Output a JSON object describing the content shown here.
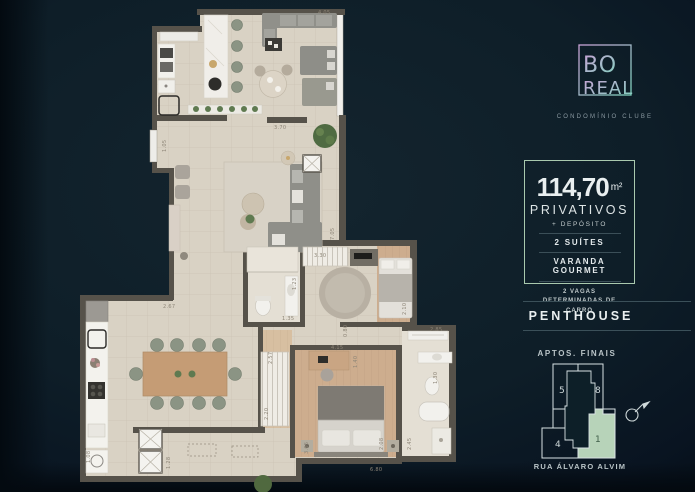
{
  "brand": {
    "line1": "BO",
    "line2": "REAL",
    "tagline": "CONDOMÍNIO CLUBE"
  },
  "specs": {
    "area_value": "114,70",
    "area_unit": "m²",
    "area_label": "PRIVATIVOS",
    "deposit": "+ DEPÓSITO",
    "features": [
      "2 SUÍTES",
      "VARANDA GOURMET"
    ],
    "parking": "2 VAGAS DETERMINADAS DE CARRO"
  },
  "unit_type": "PENTHOUSE",
  "key_plan": {
    "title": "APTOS. FINAIS",
    "street": "RUA ÁLVARO ALVIM",
    "units": [
      "5",
      "8",
      "4",
      "1"
    ],
    "highlighted_unit": "1"
  },
  "plan": {
    "dims": [
      "4.05",
      "3.70",
      "1.05",
      "7.05",
      "3.30",
      "1.23",
      "1.35",
      "2.10",
      "0.80",
      "4.15",
      "2.85",
      "2.57",
      "1.40",
      "1.30",
      "2.67",
      "2.20",
      "3.05",
      "2.08",
      "2.45",
      "6.80",
      "1.28",
      "1.08"
    ]
  },
  "colors": {
    "bg": "#0d1d27",
    "accent": "#a9c9ae",
    "key-fill": "#b7d3b9",
    "key-num": "#3f5e49",
    "logo-start": "#c9a2d6",
    "logo-end": "#7fd2bd",
    "text": "#e9eff0",
    "muted": "#b9c4c7",
    "rule": "#3b5059"
  }
}
